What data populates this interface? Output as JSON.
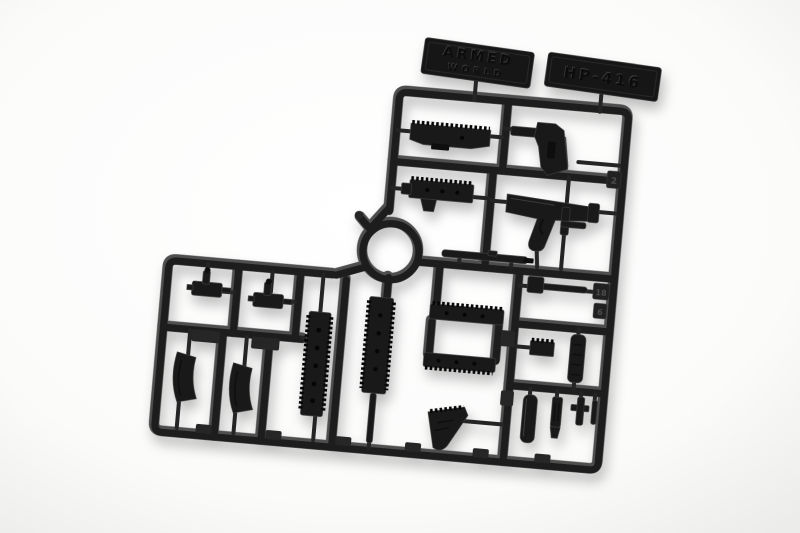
{
  "scene": {
    "description": "Injection-molded dark grey plastic model-kit sprue (runner) holding small-scale rifle weapon parts, photographed at a slight angle on a seamless white background",
    "background_color": "#fdfdfc",
    "background_edge_color": "#ecedeb",
    "plastic_color": "#1d1d1d",
    "plastic_highlight_color": "#4e4e4e",
    "part_color": "#191919"
  },
  "brand_plate": {
    "line1": "ARMED",
    "line2": "WORLD"
  },
  "model_plate": {
    "text": "HP-416"
  },
  "number_tabs": [
    "2",
    "18",
    "6"
  ],
  "parts": [
    "ring-connector",
    "upper-receiver",
    "buttstock",
    "rail-cover",
    "lower-receiver",
    "barrel",
    "gas-block",
    "gas-block",
    "magazine",
    "magazine",
    "rail-handguard",
    "barrel-rail-assembly",
    "handguard-half",
    "handguard-half",
    "foregrip",
    "charging-handle",
    "stock-pad",
    "rail-riser",
    "suppressor",
    "flash-hider",
    "front-sight",
    "connector-pin",
    "sight-post"
  ]
}
